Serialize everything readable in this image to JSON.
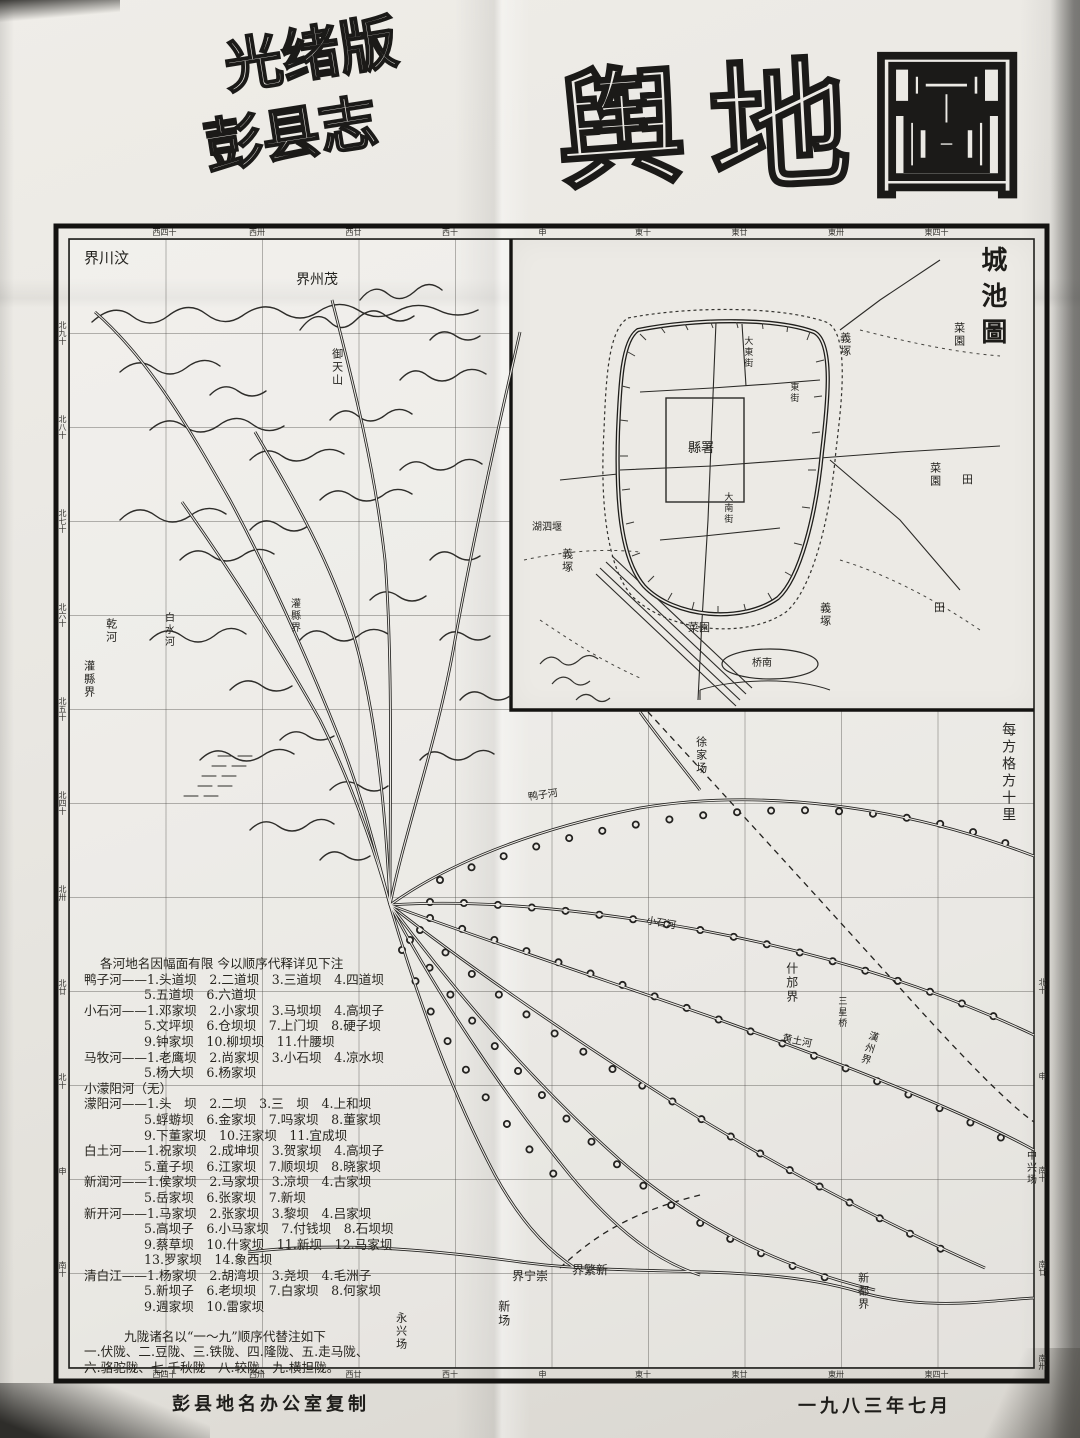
{
  "title": {
    "edition_line1": "光绪版",
    "edition_line2": "彭县志",
    "main_char1": "舆",
    "main_char2": "地",
    "main_char3": "圖"
  },
  "inset": {
    "title": "城池圖",
    "labels": {
      "yamen": "縣署",
      "dadongjie": "大東街",
      "dananjie": "大南街",
      "dongjie": "東街",
      "caiyuan": "菜園",
      "yizhong": "義塚",
      "tian": "田",
      "husiyan": "湖泗堰",
      "nanqiao": "桥南"
    }
  },
  "map": {
    "scale_note": "每方格方十里",
    "labels": {
      "wenchuan": "界川汶",
      "maozhou": "界州茂",
      "yutianshan": "御天山",
      "qianhe": "乾河",
      "guanxian1": "灌縣界",
      "baishuihe": "白水河",
      "guanxian2": "灌縣界",
      "yazihe": "鸭子河",
      "xujiachang": "徐家场",
      "shifang": "什邡界",
      "sanxingqiao": "三星桥",
      "hanzhou": "漢州界",
      "huangtuhe": "黄土河",
      "xiaoshihe": "小石河",
      "zhongxingchang": "中兴场",
      "xindu": "新都界",
      "chongning": "界宁崇",
      "xinfan": "界繁新",
      "xinchang": "新场",
      "yongxingchang": "永兴场"
    },
    "edges": {
      "top": [
        "西四十",
        "西卅",
        "西廿",
        "西十",
        "申",
        "東十",
        "東廿",
        "東卅",
        "東四十"
      ],
      "bottom": [
        "西四十",
        "西卅",
        "西廿",
        "西十",
        "申",
        "東十",
        "東廿",
        "東卅",
        "東四十"
      ],
      "left": [
        "北九十",
        "北八十",
        "北七十",
        "北六十",
        "北五十",
        "北四十",
        "北卅",
        "北廿",
        "北十",
        "申",
        "南十"
      ],
      "right": [
        "北十",
        "申",
        "南十",
        "南廿",
        "南卅"
      ]
    }
  },
  "legend": {
    "lines": [
      "各河地名因幅面有限 今以顺序代释详见下注",
      "鸭子河——1.头道坝　2.二道坝　3.三道坝　4.四道坝",
      "5.五道坝　6.六道坝",
      "小石河——1.邓家坝　2.小家坝　3.马坝坝　4.高坝子",
      "5.文坪坝　6.仓坝坝　7.上门坝　8.硬子坝",
      "9.钟家坝　10.柳坝坝　11.什腰坝",
      "马牧河——1.老鹰坝　2.尚家坝　3.小石坝　4.凉水坝",
      "5.杨大坝　6.杨家坝",
      "小濛阳河（无）",
      "濛阳河——1.头　坝　2.二坝　3.三　坝　4.上和坝",
      "5.蜉蝣坝　6.金家坝　7.吗家坝　8.董家坝",
      "9.下董家坝　10.汪家坝　11.宜成坝",
      "白土河——1.祝家坝　2.成坤坝　3.贺家坝　4.高坝子",
      "5.童子坝　6.江家坝　7.顺坝坝　8.晓家坝",
      "新润河——1.侯家坝　2.马家坝　3.凉坝　4.古家坝",
      "5.岳家坝　6.张家坝　7.新坝",
      "新开河——1.马家坝　2.张家坝　3.黎坝　4.吕家坝",
      "5.高坝子　6.小马家坝　7.付钱坝　8.石坝坝",
      "9.蔡草坝　10.什家坝　11.新坝　12.马家坝",
      "13.罗家坝　14.象西坝",
      "清白江——1.杨家坝　2.胡湾坝　3.尧坝　4.毛洲子",
      "5.新坝子　6.老坝坝　7.白家坝　8.何家坝",
      "9.週家坝　10.雷家坝",
      "九陇诸名以“一～九”顺序代替注如下",
      "一.伏陇、二.豆陇、三.铁陇、四.隆陇、五.走马陇、",
      "六.骆驼陇、七.千秋陇　八.较陇、九.横担陇。"
    ]
  },
  "footer": {
    "left": "彭县地名办公室复制",
    "right": "一九八三年七月"
  }
}
